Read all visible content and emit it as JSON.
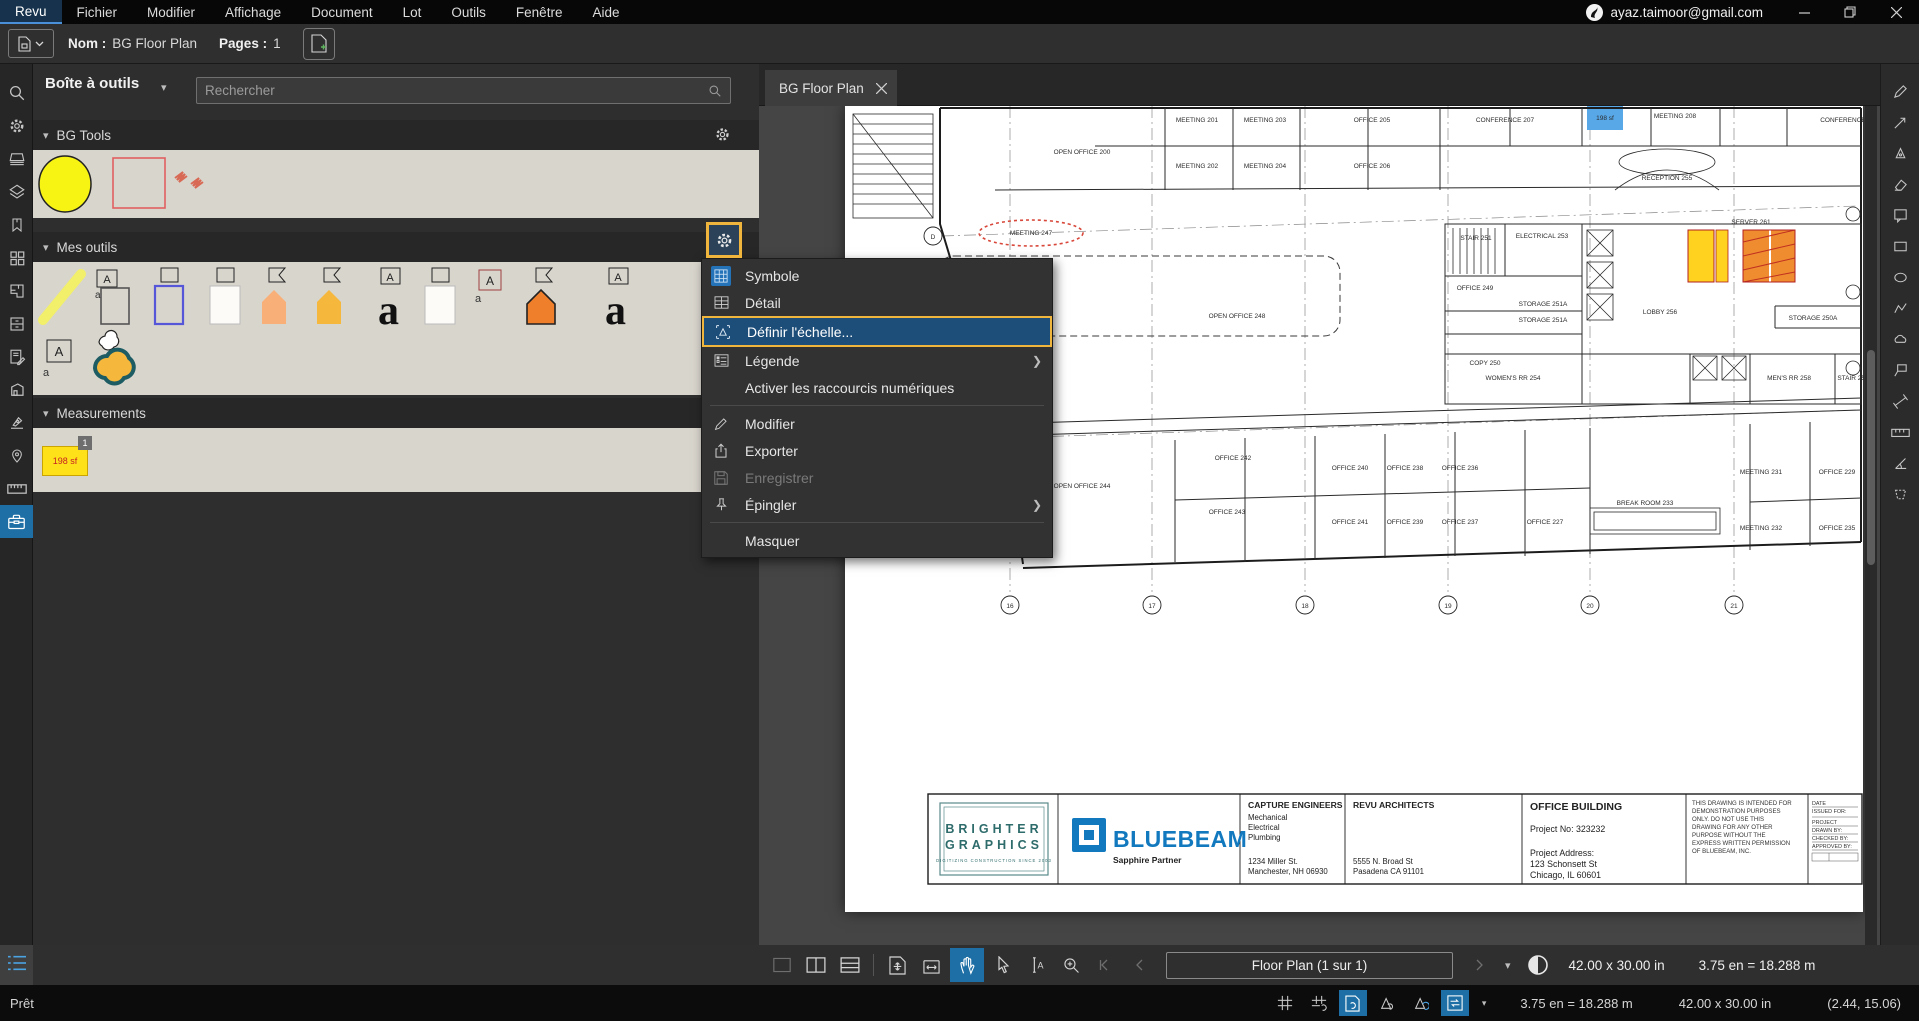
{
  "menubar": {
    "items": [
      {
        "label": "Revu",
        "active": true
      },
      {
        "label": "Fichier"
      },
      {
        "label": "Modifier"
      },
      {
        "label": "Affichage"
      },
      {
        "label": "Document"
      },
      {
        "label": "Lot"
      },
      {
        "label": "Outils"
      },
      {
        "label": "Fenêtre"
      },
      {
        "label": "Aide"
      }
    ],
    "account": "ayaz.taimoor@gmail.com"
  },
  "filebar": {
    "nom_label": "Nom :",
    "nom_value": "BG Floor Plan",
    "pages_label": "Pages :",
    "pages_value": "1"
  },
  "toolbox": {
    "title": "Boîte à outils",
    "search_placeholder": "Rechercher",
    "section_bg_tools": "BG Tools",
    "section_mes_outils": "Mes outils",
    "section_measurements": "Measurements",
    "measurement_item": {
      "badge": "1",
      "label": "198 sf"
    }
  },
  "context_menu": {
    "items": [
      {
        "label": "Symbole"
      },
      {
        "label": "Détail"
      },
      {
        "label": "Définir l'échelle...",
        "highlighted": true
      },
      {
        "label": "Légende",
        "submenu": true
      },
      {
        "label": "Activer les raccourcis numériques"
      },
      {
        "label": "Modifier"
      },
      {
        "label": "Exporter"
      },
      {
        "label": "Enregistrer",
        "disabled": true
      },
      {
        "label": "Épingler",
        "submenu": true
      },
      {
        "label": "Masquer"
      }
    ]
  },
  "document": {
    "tab": "BG Floor Plan"
  },
  "bottom_toolbar": {
    "page_nav": "Floor Plan (1 sur 1)",
    "size": "42.00 x 30.00 in",
    "scale": "3.75 en = 18.288 m"
  },
  "status_bar": {
    "ready": "Prêt",
    "scale": "3.75 en = 18.288 m",
    "size": "42.00 x 30.00 in",
    "coords": "(2.44, 15.06)"
  },
  "floorplan": {
    "rooms": [
      {
        "x": 352,
        "y": 16,
        "label": "MEETING 201"
      },
      {
        "x": 420,
        "y": 16,
        "label": "MEETING 203"
      },
      {
        "x": 527,
        "y": 16,
        "label": "OFFICE 205"
      },
      {
        "x": 660,
        "y": 16,
        "label": "CONFERENCE 207"
      },
      {
        "x": 830,
        "y": 12,
        "label": "MEETING 208"
      },
      {
        "x": 998,
        "y": 16,
        "label": "CONFERENCE"
      },
      {
        "x": 760,
        "y": 14,
        "label": "198 sf",
        "color": "#c42222"
      },
      {
        "x": 237,
        "y": 48,
        "label": "OPEN OFFICE 200"
      },
      {
        "x": 352,
        "y": 62,
        "label": "MEETING 202"
      },
      {
        "x": 420,
        "y": 62,
        "label": "MEETING 204"
      },
      {
        "x": 527,
        "y": 62,
        "label": "OFFICE 206"
      },
      {
        "x": 822,
        "y": 74,
        "label": "RECEPTION 255"
      },
      {
        "x": 186,
        "y": 129,
        "label": "MEETING 247"
      },
      {
        "x": 392,
        "y": 212,
        "label": "OPEN OFFICE 248"
      },
      {
        "x": 631,
        "y": 134,
        "label": "STAIR 251"
      },
      {
        "x": 697,
        "y": 132,
        "label": "ELECTRICAL 253"
      },
      {
        "x": 630,
        "y": 184,
        "label": "OFFICE 249"
      },
      {
        "x": 698,
        "y": 200,
        "label": "STORAGE 251A"
      },
      {
        "x": 698,
        "y": 216,
        "label": "STORAGE 251A"
      },
      {
        "x": 640,
        "y": 259,
        "label": "COPY 250"
      },
      {
        "x": 668,
        "y": 274,
        "label": "WOMEN'S RR 254"
      },
      {
        "x": 815,
        "y": 208,
        "label": "LOBBY 256"
      },
      {
        "x": 906,
        "y": 118,
        "label": "SERVER 261",
        "color": "#c42222"
      },
      {
        "x": 968,
        "y": 214,
        "label": "STORAGE 250A"
      },
      {
        "x": 944,
        "y": 274,
        "label": "MEN'S RR 258"
      },
      {
        "x": 1008,
        "y": 274,
        "label": "STAIR 257"
      },
      {
        "x": 237,
        "y": 382,
        "label": "OPEN OFFICE 244"
      },
      {
        "x": 388,
        "y": 354,
        "label": "OFFICE 242"
      },
      {
        "x": 505,
        "y": 364,
        "label": "OFFICE 240"
      },
      {
        "x": 560,
        "y": 364,
        "label": "OFFICE 238"
      },
      {
        "x": 615,
        "y": 364,
        "label": "OFFICE 236"
      },
      {
        "x": 916,
        "y": 368,
        "label": "MEETING 231"
      },
      {
        "x": 992,
        "y": 368,
        "label": "OFFICE 229"
      },
      {
        "x": 382,
        "y": 408,
        "label": "OFFICE 243"
      },
      {
        "x": 505,
        "y": 418,
        "label": "OFFICE 241"
      },
      {
        "x": 560,
        "y": 418,
        "label": "OFFICE 239"
      },
      {
        "x": 615,
        "y": 418,
        "label": "OFFICE 237"
      },
      {
        "x": 700,
        "y": 418,
        "label": "OFFICE 227"
      },
      {
        "x": 800,
        "y": 399,
        "label": "BREAK ROOM 233"
      },
      {
        "x": 916,
        "y": 424,
        "label": "MEETING 232"
      },
      {
        "x": 992,
        "y": 424,
        "label": "OFFICE 235"
      }
    ],
    "grid_bubbles": [
      {
        "x": 165,
        "label": "16"
      },
      {
        "x": 307,
        "label": "17"
      },
      {
        "x": 460,
        "label": "18"
      },
      {
        "x": 603,
        "label": "19"
      },
      {
        "x": 745,
        "label": "20"
      },
      {
        "x": 889,
        "label": "21"
      }
    ],
    "row_bubbles": [
      {
        "y": 130,
        "label": "D"
      },
      {
        "y": 334,
        "label": "C"
      }
    ],
    "title_block": {
      "brighter": {
        "line1": "BRIGHTER",
        "line2": "GRAPHICS",
        "tagline": "DIGITIZING CONSTRUCTION SINCE 2003"
      },
      "bluebeam": {
        "name": "BLUEBEAM",
        "partner": "Sapphire Partner"
      },
      "capture": {
        "title": "CAPTURE ENGINEERS",
        "l1": "Mechanical",
        "l2": "Electrical",
        "l3": "Plumbing",
        "a1": "1234 Miller St.",
        "a2": "Manchester, NH 06930"
      },
      "revu": {
        "title": "REVU ARCHITECTS",
        "a1": "5555 N. Broad St",
        "a2": "Pasadena CA 91101"
      },
      "office": {
        "title": "OFFICE BUILDING",
        "project_no": "Project No: 323232",
        "addr_label": "Project Address:",
        "a1": "123 Schonsett St",
        "a2": "Chicago, IL 60601"
      },
      "disclaimer": [
        "THIS DRAWING IS INTENDED FOR",
        "DEMONSTRATION PURPOSES",
        "ONLY.  DO NOT USE THIS",
        "DRAWING FOR ANY OTHER",
        "PURPOSE WITHOUT THE",
        "EXPRESS WRITTEN PERMISSION",
        "OF BLUEBEAM, INC."
      ],
      "fields": [
        "DATE",
        "ISSUED FOR:",
        "PROJECT",
        "DRAWN BY:",
        "CHECKED BY:",
        "APPROVED BY:"
      ]
    }
  }
}
